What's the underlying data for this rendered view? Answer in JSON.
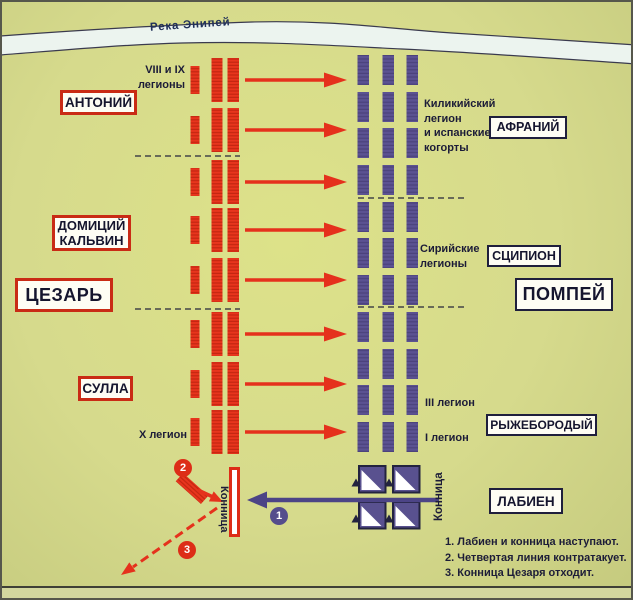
{
  "river": {
    "label": "Река Энипей"
  },
  "caesar_side": {
    "army_name": "ЦЕЗАРЬ",
    "commanders": {
      "antony": "АНТОНИЙ",
      "domitius_calvinus": "ДОМИЦИЙ\nКАЛЬВИН",
      "sulla": "СУЛЛА"
    },
    "units": {
      "legions_viii_ix": "VIII и IX\nлегионы",
      "legion_x": "X легион",
      "cavalry": "Конница"
    },
    "formation": {
      "battle_lines": 3,
      "rows": 8
    },
    "color": "#e5311c"
  },
  "pompey_side": {
    "army_name": "ПОМПЕЙ",
    "commanders": {
      "afranius": "АФРАНИЙ",
      "scipio": "СЦИПИОН",
      "ahenobarbus": "РЫЖЕБОРОДЫЙ",
      "labienus": "ЛАБИЕН"
    },
    "units": {
      "cilician_spanish": "Киликийский\nлегион\nи испанские\nкогорты",
      "syrian": "Сирийские\nлегионы",
      "legion_iii": "III легион",
      "legion_i": "I легион",
      "cavalry": "Конница"
    },
    "formation": {
      "columns": 3,
      "rows": 11,
      "cavalry_squares": 4
    },
    "color": "#59518f"
  },
  "attack_arrows": 8,
  "movement_markers": {
    "m1": "1",
    "m2": "2",
    "m3": "3"
  },
  "legend": {
    "items": [
      "1. Лабиен и конница наступают.",
      "2. Четвертая линия контратакует.",
      "3. Конница Цезаря отходит."
    ]
  },
  "colors": {
    "background": "#d6da8c",
    "river": "#ecf4ef",
    "caesar_red": "#e5311c",
    "pompey_purple": "#59518f",
    "dark_line": "#26263a",
    "text": "#1c1c38"
  }
}
